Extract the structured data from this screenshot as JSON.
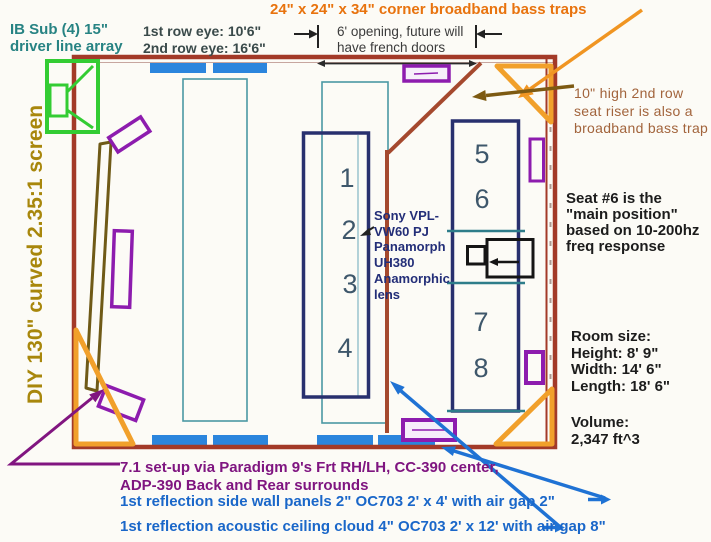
{
  "diagram": {
    "ib_sub": [
      "IB Sub (4) 15\"",
      "driver line array"
    ],
    "row_eye": [
      "1st row eye: 10'6\"",
      "2nd row eye: 16'6\""
    ],
    "corner_traps": "24\" x 24\" x 34\" corner broadband bass traps",
    "opening": [
      "6' opening, future will",
      "have french doors"
    ],
    "riser": [
      "10\" high 2nd row",
      "seat riser is also a",
      "broadband bass trap"
    ],
    "main_position": [
      "Seat #6 is the",
      "\"main position\"",
      "based on 10-200hz",
      "freq response"
    ],
    "room_size": [
      "Room size:",
      "Height: 8' 9\"",
      "Width: 14' 6\"",
      "Length: 18' 6\""
    ],
    "volume": [
      "Volume:",
      "2,347 ft^3"
    ],
    "screen": "DIY 130\" curved 2.35:1 screen",
    "projector": [
      "Sony VPL-",
      "VW60 PJ",
      "Panamorph",
      "UH380",
      "Anamorphic",
      "lens"
    ],
    "surround_setup": [
      "7.1 set-up via Paradigm 9's Frt RH/LH, CC-390 center,",
      "ADP-390 Back and Rear surrounds"
    ],
    "wall_panels": "1st reflection side wall panels 2\" OC703 2' x 4' with air gap 2\"",
    "ceiling_cloud": "1st reflection acoustic ceiling cloud 4\" OC703 2' x 12' with air gap 8\"",
    "seats_row1": [
      "1",
      "2",
      "3",
      "4"
    ],
    "seats_row2": [
      "5",
      "6",
      "7",
      "8"
    ]
  },
  "colors": {
    "wall": "#a33a28",
    "riser_line": "#a5492e",
    "seat_box": "#28306e",
    "panel_blue": "#2b85dd",
    "cloud_teal": "#4b99a3",
    "speaker_purple": "#8d1cae",
    "bass_trap_orange": "#f1a02b",
    "sub_green": "#33cc33",
    "screen_khaki": "#6f5a17",
    "annotation_orange": "#e8730e",
    "annotation_teal": "#278383",
    "annotation_purple": "#7f1580",
    "annotation_blue": "#1a67c9",
    "annotation_brown": "#a2643c",
    "annotation_gold": "#a8870c"
  }
}
